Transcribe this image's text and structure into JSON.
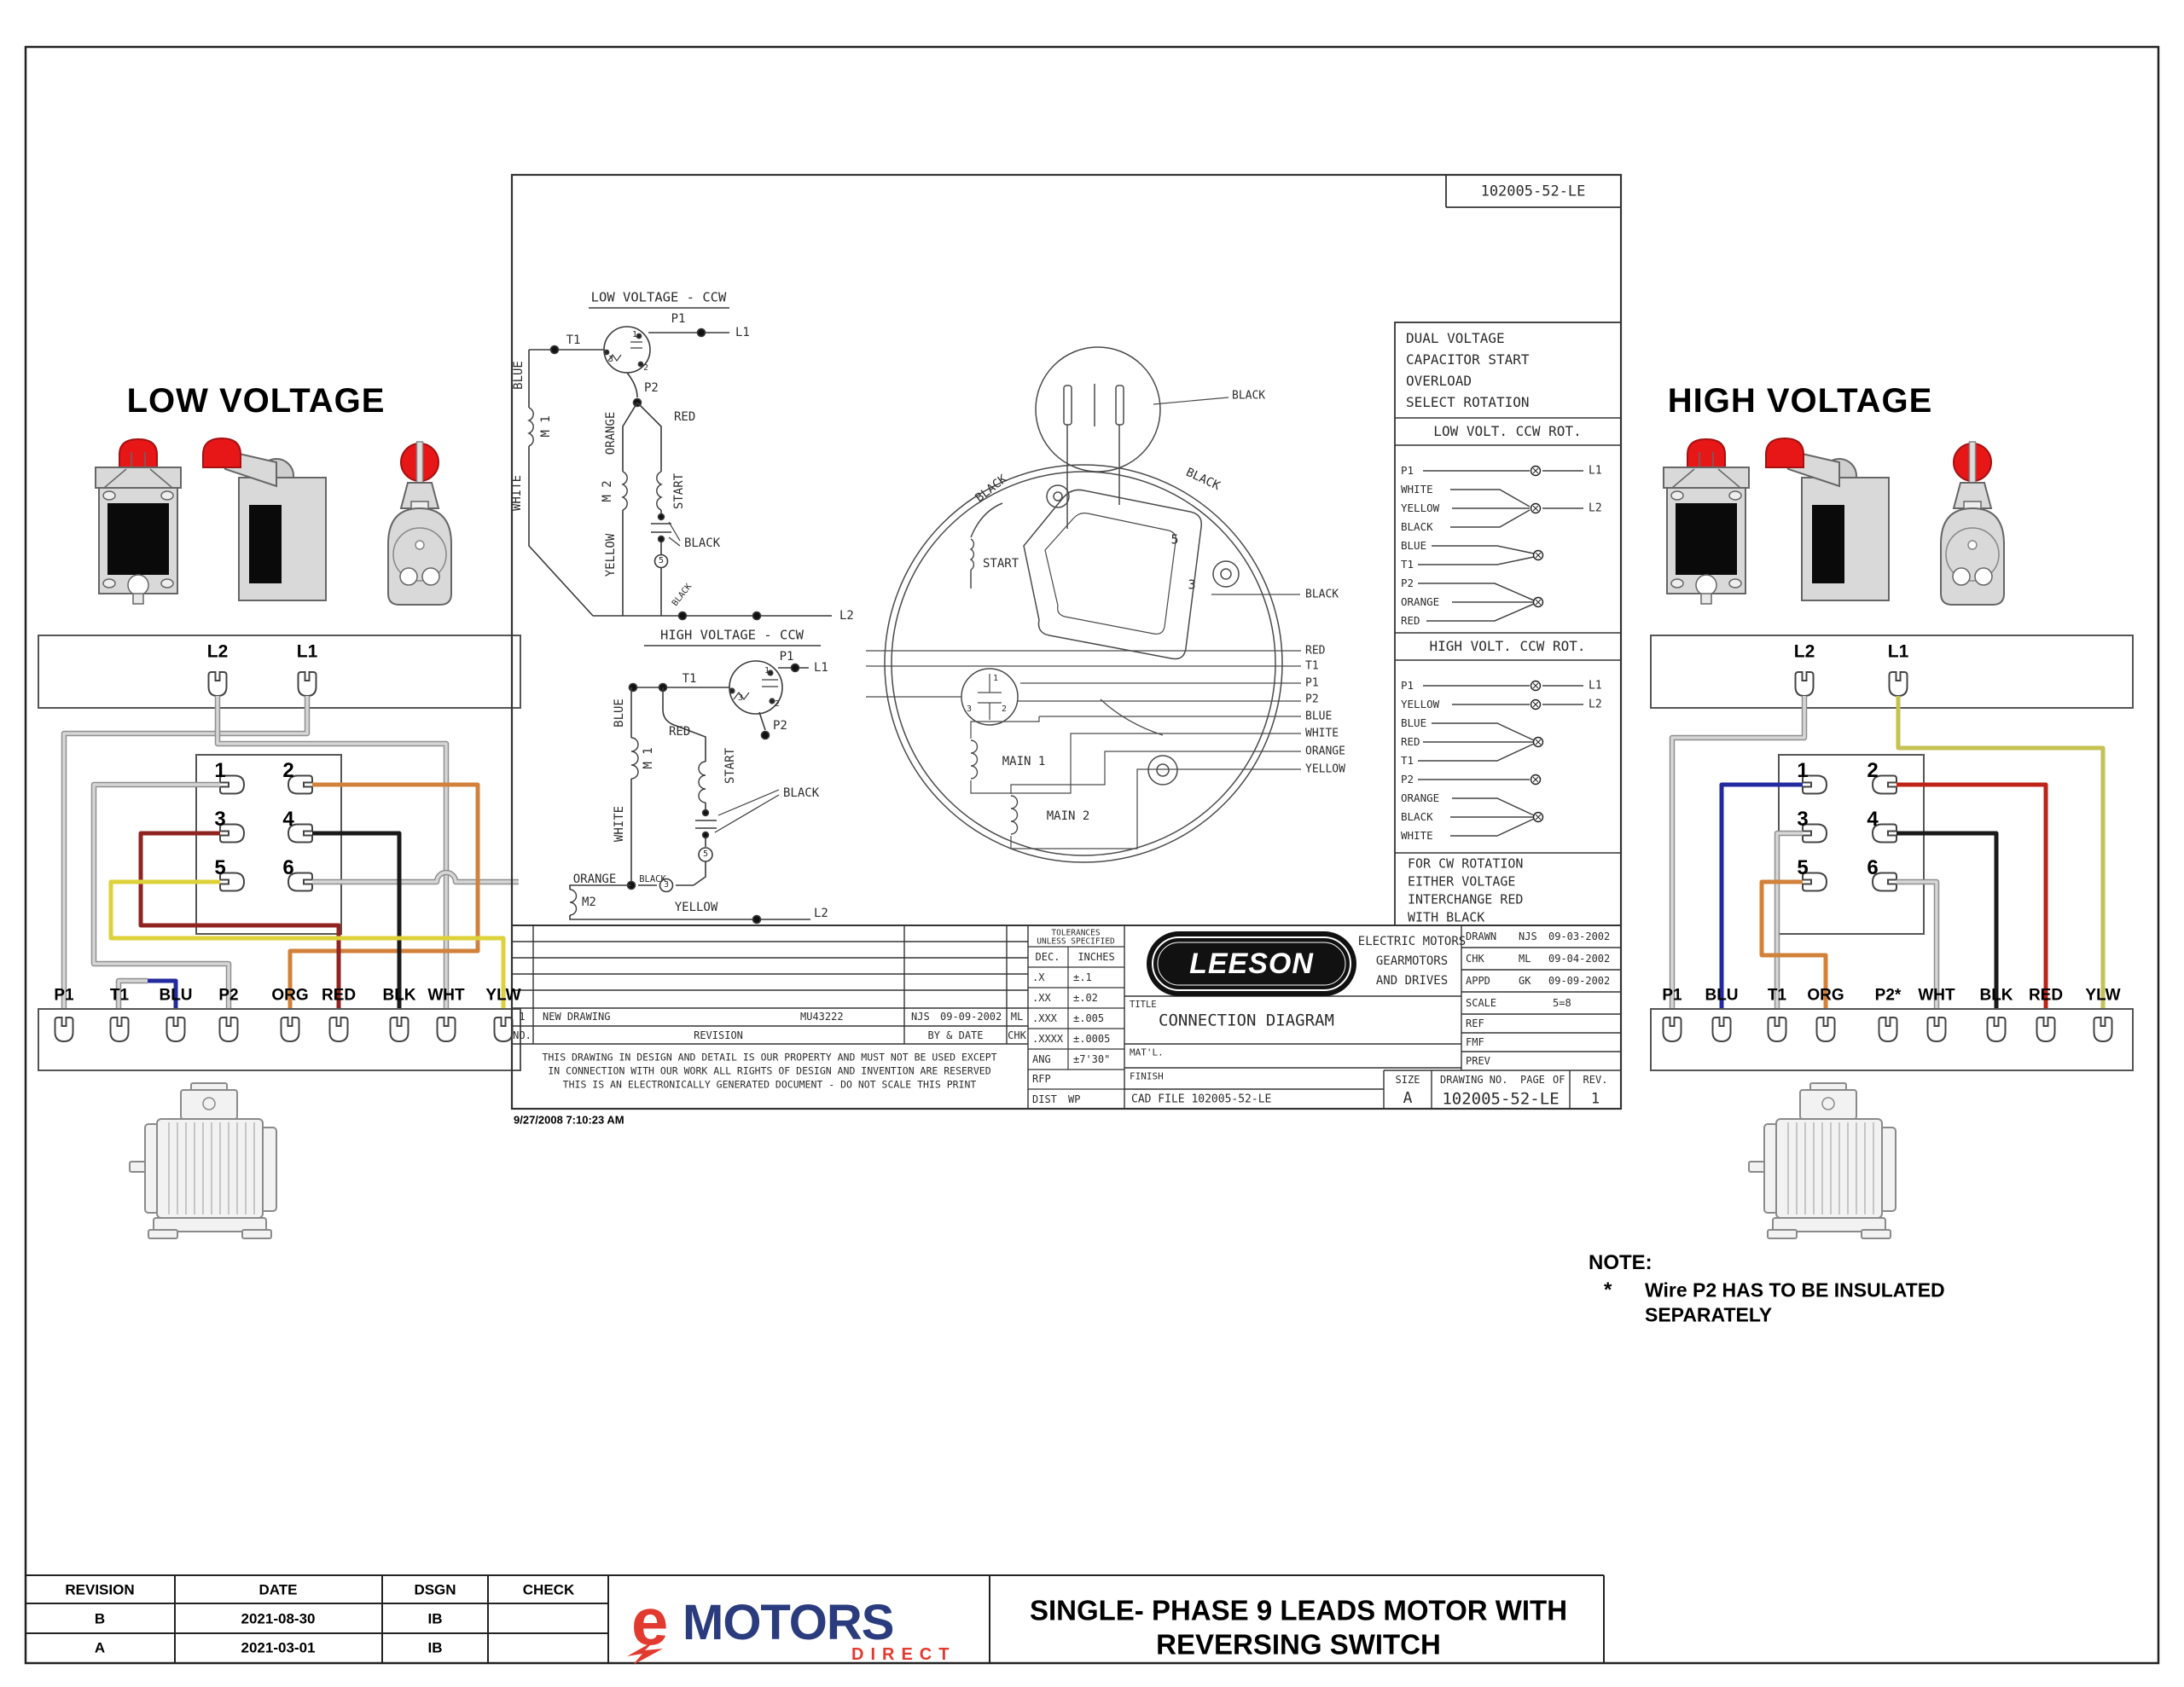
{
  "colors": {
    "brand_blue": "#2b3c7e",
    "brand_red": "#e23a2e",
    "switch_red": "#e81717",
    "wire_gray": "#c0c0c0",
    "wire_blue": "#232a9e",
    "wire_red": "#bf2318",
    "wire_dark_red": "#8f2420",
    "wire_orange": "#d2813a",
    "wire_yellow": "#ded23a",
    "wire_olive": "#c6c153",
    "wire_black": "#1a1a1a"
  },
  "low": {
    "title": "LOW VOLTAGE",
    "l2": "L2",
    "l1": "L1",
    "sw": [
      "1",
      "2",
      "3",
      "4",
      "5",
      "6"
    ],
    "leads": [
      "P1",
      "T1",
      "BLU",
      "P2",
      "ORG",
      "RED",
      "BLK",
      "WHT",
      "YLW"
    ]
  },
  "high": {
    "title": "HIGH VOLTAGE",
    "l2": "L2",
    "l1": "L1",
    "sw": [
      "1",
      "2",
      "3",
      "4",
      "5",
      "6"
    ],
    "leads": [
      "P1",
      "BLU",
      "T1",
      "ORG",
      "P2*",
      "WHT",
      "BLK",
      "RED",
      "YLW"
    ]
  },
  "note": {
    "heading": "NOTE:",
    "star": "*",
    "line1": "Wire P2 HAS TO BE INSULATED",
    "line2": "SEPARATELY"
  },
  "sheet": {
    "doc_no": "102005-52-LE",
    "info": [
      "DUAL VOLTAGE",
      "CAPACITOR START",
      "OVERLOAD",
      "SELECT ROTATION"
    ],
    "low_rot": "LOW VOLT. CCW ROT.",
    "high_rot": "HIGH VOLT. CCW ROT.",
    "low_leads": [
      "P1",
      "WHITE",
      "YELLOW",
      "BLACK",
      "BLUE",
      "T1",
      "P2",
      "ORANGE",
      "RED"
    ],
    "high_leads": [
      "P1",
      "YELLOW",
      "BLUE",
      "RED",
      "T1",
      "P2",
      "ORANGE",
      "BLACK",
      "WHITE"
    ],
    "l1": "L1",
    "l2": "L2",
    "cw_note": [
      "FOR CW ROTATION",
      "EITHER VOLTAGE",
      "INTERCHANGE RED",
      "WITH BLACK"
    ],
    "sch_low": {
      "title": "LOW VOLTAGE - CCW",
      "t1": "T1",
      "p1": "P1",
      "p2": "P2",
      "l1": "L1",
      "l2": "L2",
      "red": "RED",
      "blue": "BLUE",
      "m1": "M 1",
      "white": "WHITE",
      "orange": "ORANGE",
      "m2": "M 2",
      "yellow": "YELLOW",
      "start": "START",
      "black": "BLACK",
      "black_small": "BLACK",
      "n1": "1",
      "n2": "2",
      "n3": "3",
      "n5": "5"
    },
    "sch_high": {
      "title": "HIGH VOLTAGE - CCW",
      "t1": "T1",
      "p1": "P1",
      "p2": "P2",
      "l1": "L1",
      "l2": "L2",
      "blue": "BLUE",
      "m1": "M 1",
      "red": "RED",
      "white": "WHITE",
      "start": "START",
      "black": "BLACK",
      "black_small": "BLACK",
      "orange": "ORANGE",
      "m2": "M2",
      "yellow": "YELLOW",
      "n1": "1",
      "n2": "2",
      "n3": "3",
      "n5": "5",
      "n3b": "3"
    },
    "motor": {
      "black_tl": "BLACK",
      "black_tr": "BLACK",
      "black_top": "BLACK",
      "black_right": "BLACK",
      "start": "START",
      "main1": "MAIN 1",
      "main2": "MAIN 2",
      "n5": "5",
      "n3": "3",
      "cap1": "1",
      "cap2": "2",
      "cap3": "3",
      "stack": [
        "RED",
        "T1",
        "P1",
        "P2",
        "BLUE",
        "WHITE",
        "ORANGE",
        "YELLOW"
      ]
    },
    "tb": {
      "tol_h1": "TOLERANCES",
      "tol_h2": "UNLESS SPECIFIED",
      "dec": "DEC.",
      "inches": "INCHES",
      "tol": [
        [
          ".X",
          "±.1"
        ],
        [
          ".XX",
          "±.02"
        ],
        [
          ".XXX",
          "±.005"
        ],
        [
          ".XXXX",
          "±.0005"
        ],
        [
          "ANG",
          "±7'30\""
        ]
      ],
      "brand": "LEESON",
      "brand1": "ELECTRIC MOTORS",
      "brand2": "GEARMOTORS",
      "brand3": "AND DRIVES",
      "title_label": "TITLE",
      "title_value": "CONNECTION DIAGRAM",
      "matl": "MAT'L.",
      "finish": "FINISH",
      "cad": "CAD FILE 102005-52-LE",
      "drawn": {
        "label": "DRAWN",
        "by": "NJS",
        "date": "09-03-2002"
      },
      "chk": {
        "label": "CHK",
        "by": "ML",
        "date": "09-04-2002"
      },
      "appd": {
        "label": "APPD",
        "by": "GK",
        "date": "09-09-2002"
      },
      "scale_label": "SCALE",
      "scale_value": "5=8",
      "ref": "REF",
      "fmf": "FMF",
      "prev": "PREV",
      "size_label": "SIZE",
      "size_value": "A",
      "dwg_label": "DRAWING NO.",
      "page_label": "PAGE",
      "of_label": "OF",
      "dwg_no": "102005-52-LE",
      "rev_label": "REV.",
      "rev_value": "1",
      "row1": {
        "no": "1",
        "desc": "NEW DRAWING",
        "code": "MU43222",
        "by": "NJS",
        "date": "09-09-2002",
        "chk": "ML"
      },
      "hdr": {
        "no": "NO.",
        "revision": "REVISION",
        "by": "BY & DATE",
        "chk": "CHK"
      },
      "disc1": "THIS DRAWING IN DESIGN AND DETAIL IS OUR PROPERTY AND MUST NOT BE USED EXCEPT",
      "disc2": "IN CONNECTION WITH OUR WORK ALL RIGHTS OF DESIGN AND INVENTION ARE RESERVED",
      "disc3": "THIS IS AN ELECTRONICALLY GENERATED DOCUMENT - DO NOT SCALE THIS PRINT",
      "rfp": "RFP",
      "dist": "DIST",
      "wp": "WP"
    },
    "timestamp": "9/27/2008 7:10:23 AM"
  },
  "footer": {
    "headers": [
      "REVISION",
      "DATE",
      "DSGN",
      "CHECK"
    ],
    "rows": [
      [
        "B",
        "2021-08-30",
        "IB",
        ""
      ],
      [
        "A",
        "2021-03-01",
        "IB",
        ""
      ]
    ],
    "brand_e": "e",
    "brand_motors": "MOTORS",
    "brand_direct": "DIRECT",
    "title1": "SINGLE- PHASE 9 LEADS MOTOR WITH",
    "title2": "REVERSING SWITCH"
  }
}
